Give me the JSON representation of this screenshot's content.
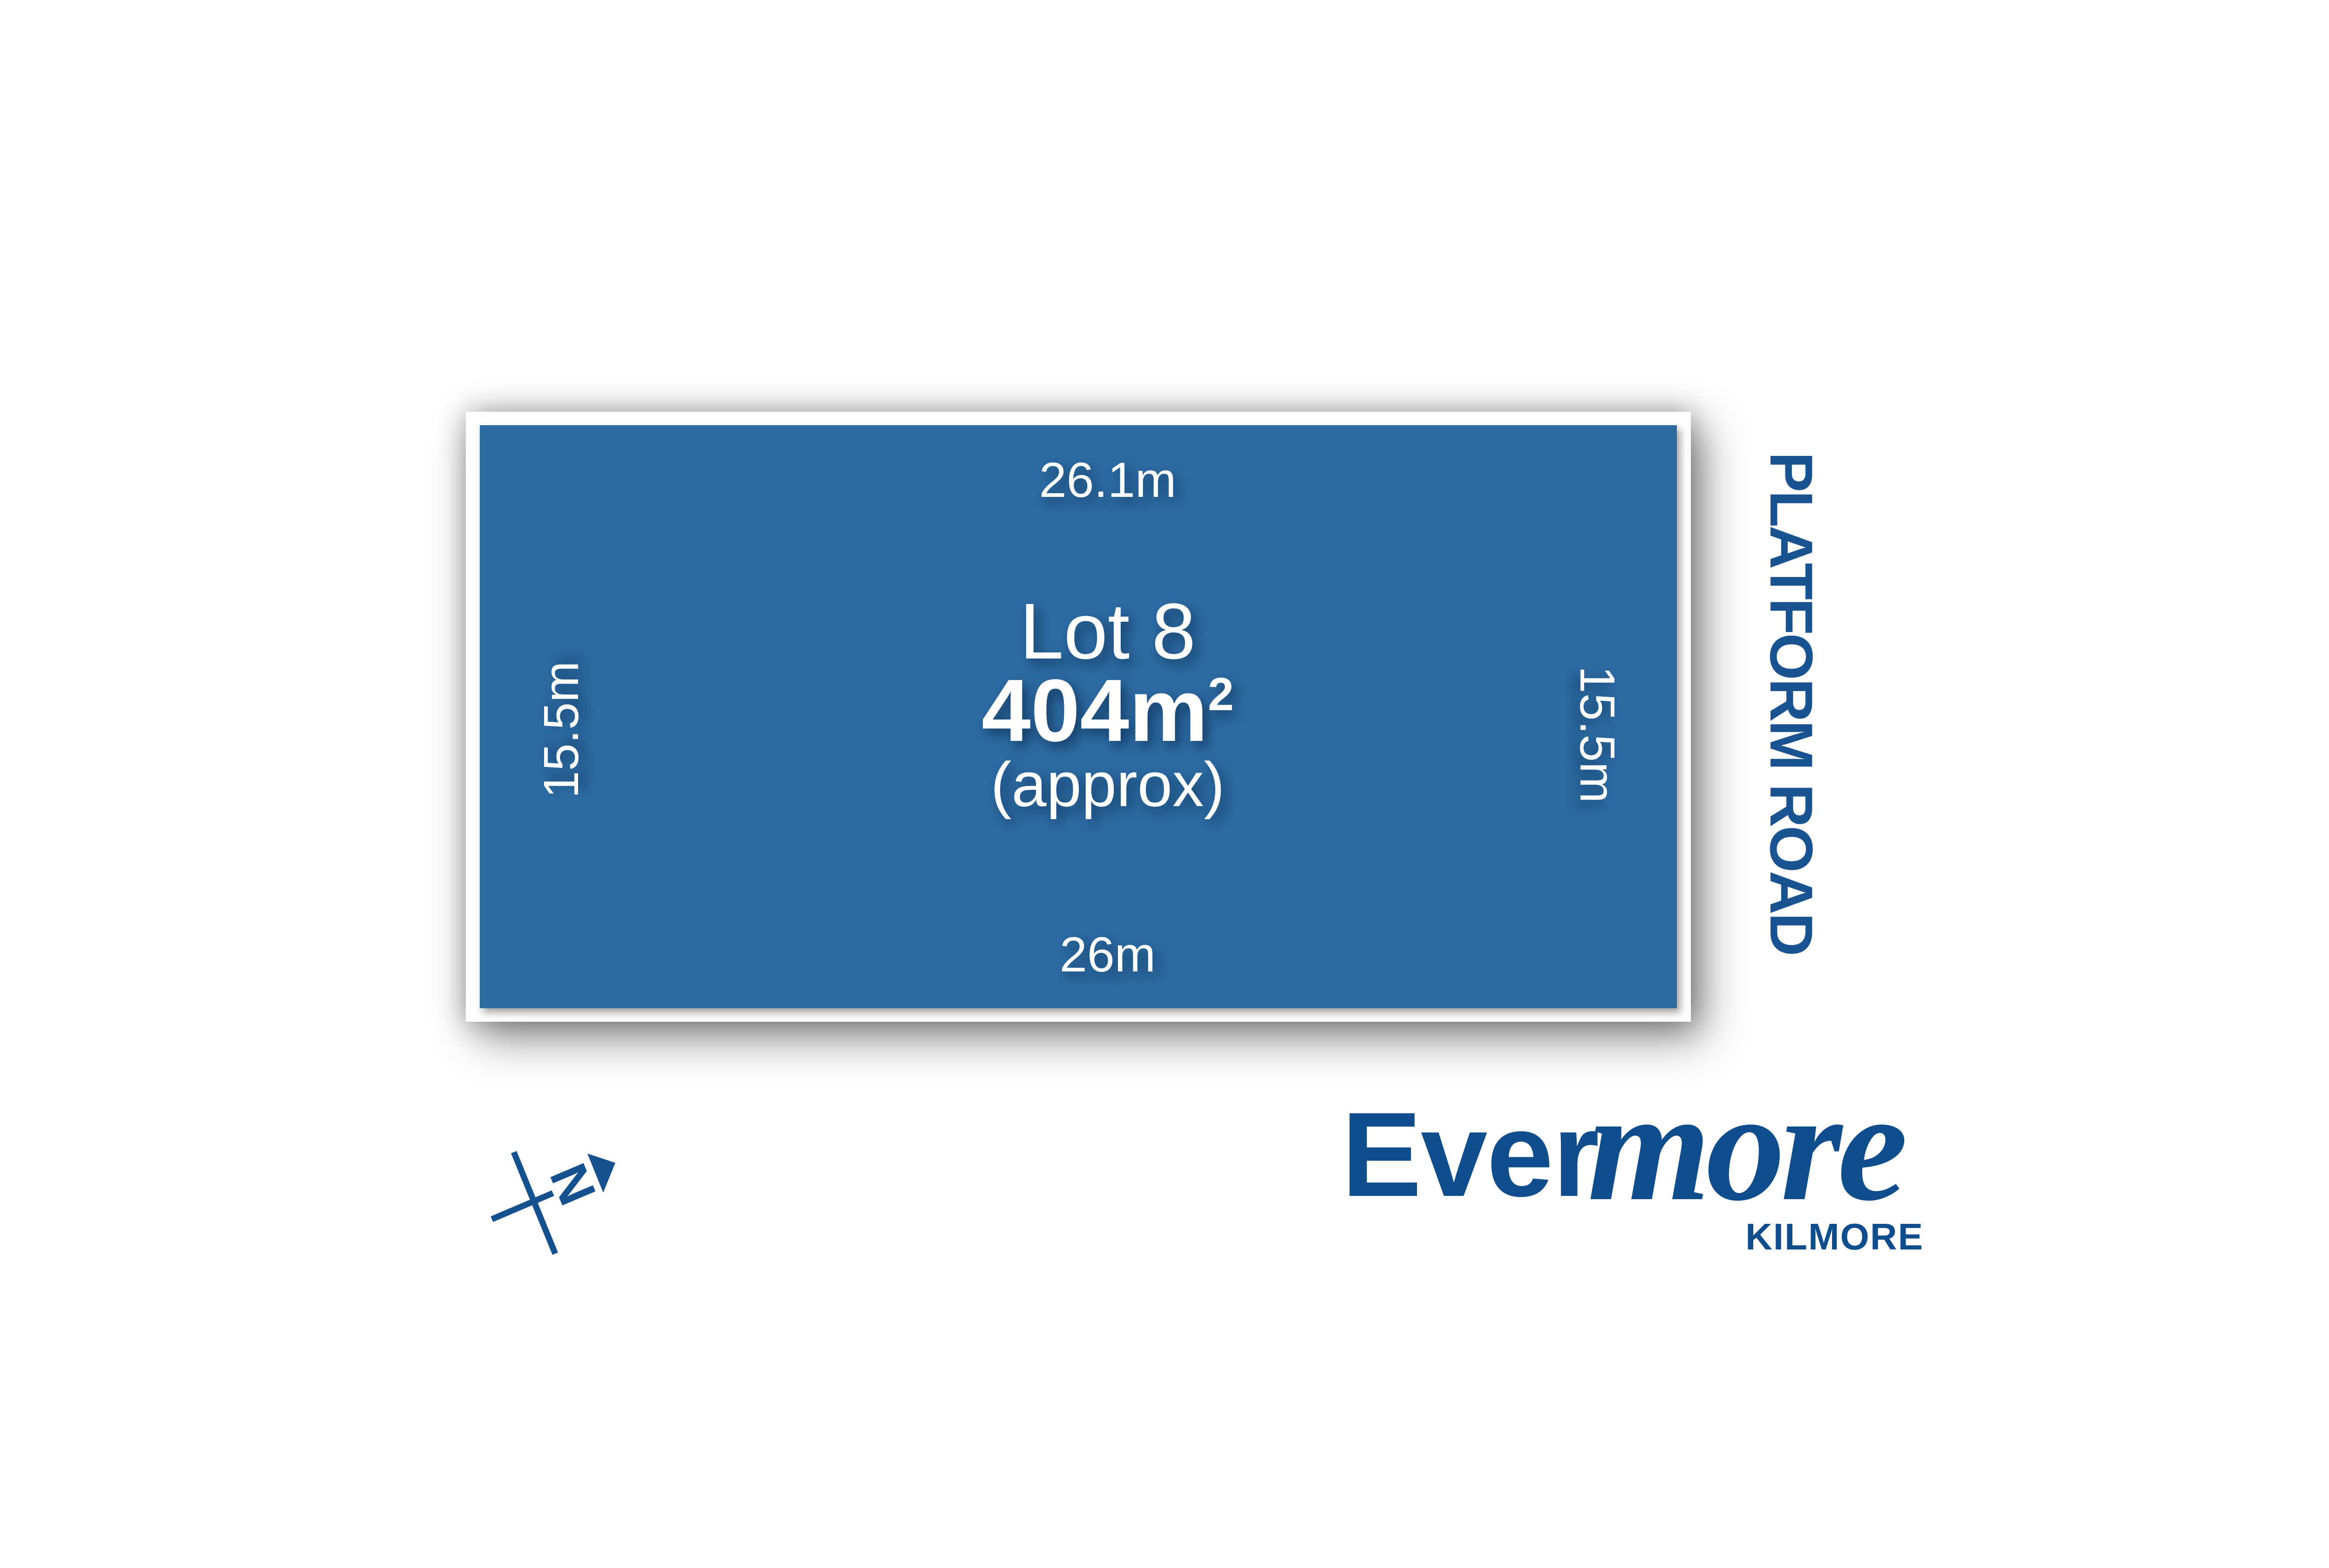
{
  "canvas": {
    "background": "#ffffff"
  },
  "parcel": {
    "fill_color": "#2d6ba3",
    "lot_label": "Lot 8",
    "area_value": "404m",
    "area_superscript": "2",
    "area_qualifier": "(approx)",
    "dimensions": {
      "top": "26.1m",
      "bottom": "26m",
      "left": "15.5m",
      "right": "15.5m"
    }
  },
  "road": {
    "label": "PLATFORM ROAD",
    "color": "#1a5391"
  },
  "brand": {
    "word_upright": "Ever",
    "word_script": "more",
    "suburb": "KILMORE",
    "color": "#0f4d8c"
  },
  "compass": {
    "north_label": "N",
    "color": "#15518f"
  }
}
